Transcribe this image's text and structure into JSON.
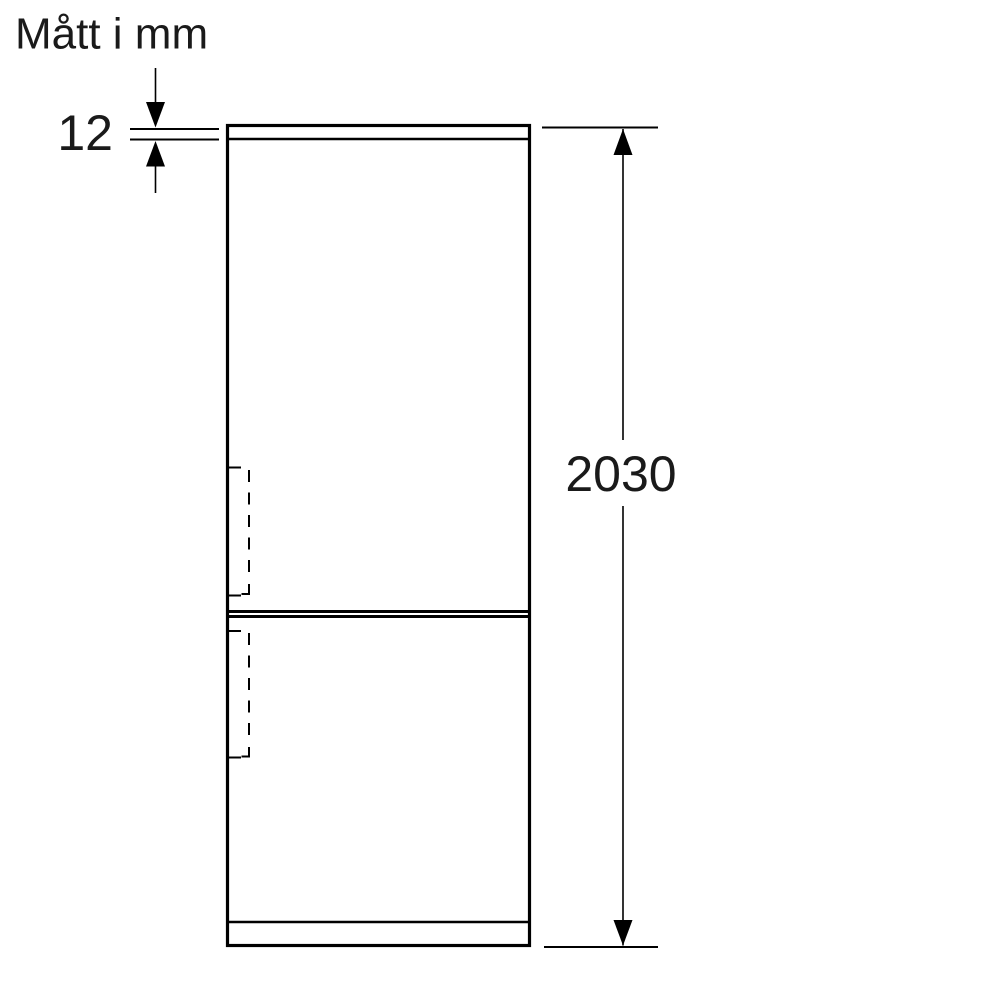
{
  "title": "Mått i mm",
  "dimensions": {
    "top_panel_thickness": {
      "label": "12"
    },
    "overall_height": {
      "label": "2030"
    }
  },
  "colors": {
    "line": "#000000",
    "text": "#1a1a1a",
    "background": "#ffffff"
  }
}
